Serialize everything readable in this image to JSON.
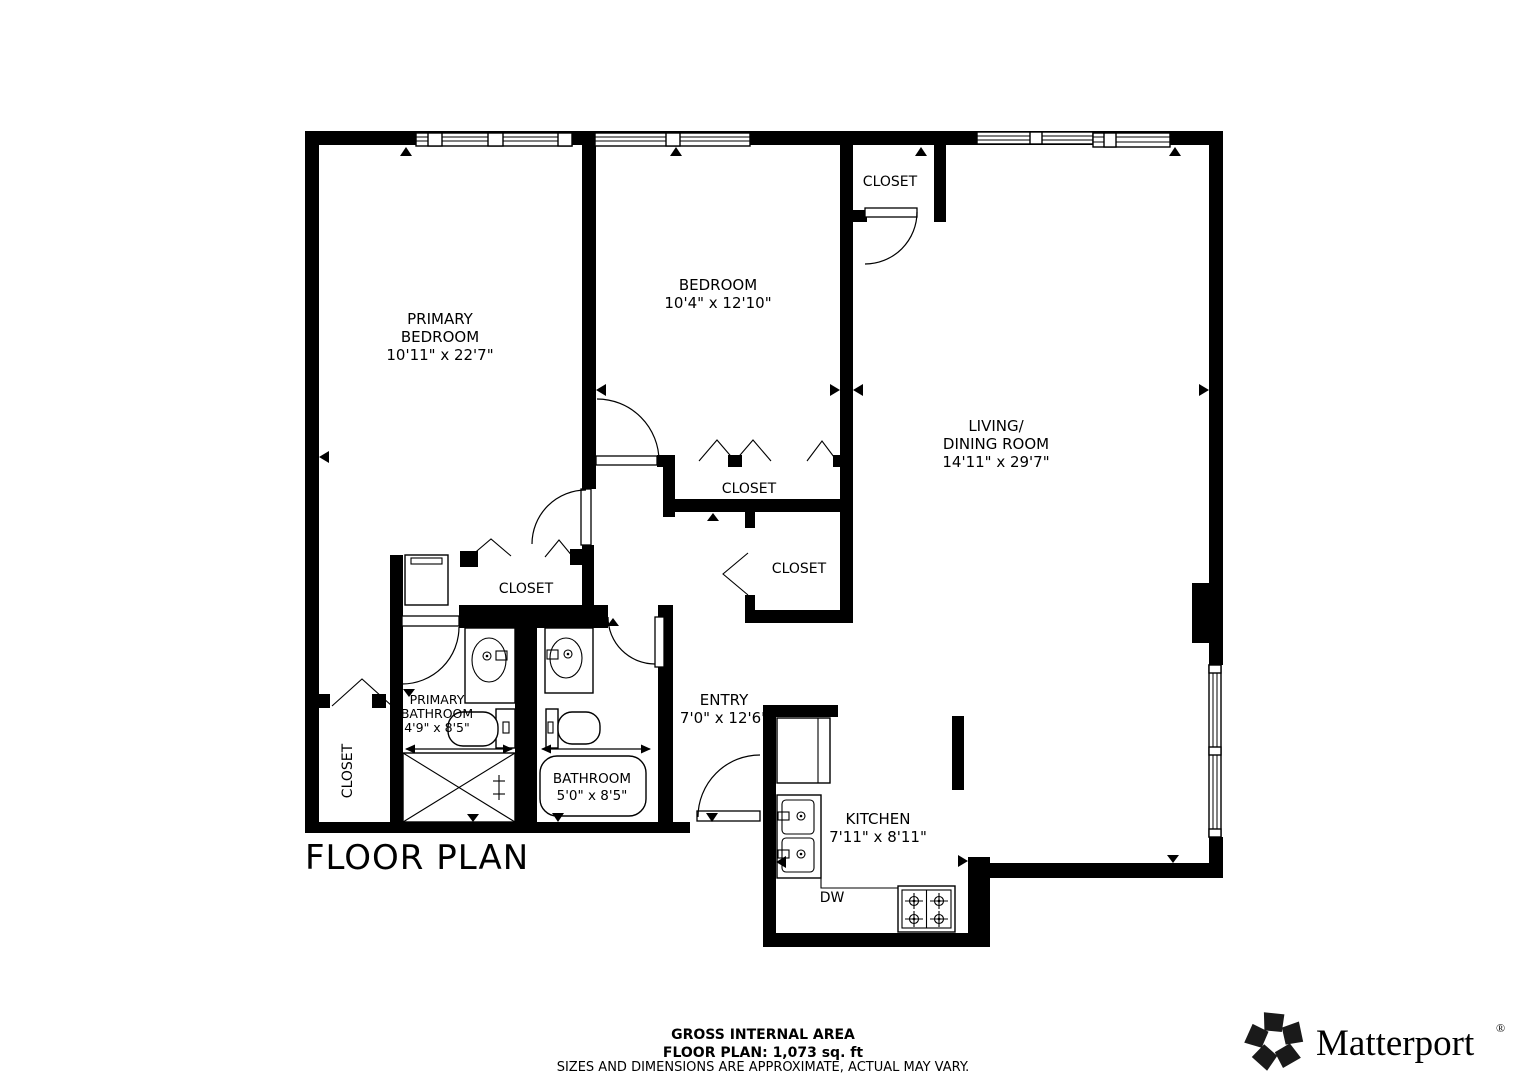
{
  "title": "FLOOR PLAN",
  "plan": {
    "rooms": {
      "primary_bedroom": {
        "lines": [
          "PRIMARY",
          "BEDROOM",
          "10'11\" x 22'7\""
        ]
      },
      "bedroom": {
        "lines": [
          "BEDROOM",
          "10'4\" x 12'10\""
        ]
      },
      "living_dining": {
        "lines": [
          "LIVING/",
          "DINING ROOM",
          "14'11\" x 29'7\""
        ]
      },
      "entry": {
        "lines": [
          "ENTRY",
          "7'0\" x 12'6\""
        ]
      },
      "kitchen": {
        "lines": [
          "KITCHEN",
          "7'11\" x 8'11\""
        ]
      },
      "primary_bathroom": {
        "lines": [
          "PRIMARY",
          "BATHROOM",
          "4'9\" x 8'5\""
        ]
      },
      "bathroom": {
        "lines": [
          "BATHROOM",
          "5'0\" x 8'5\""
        ]
      },
      "closet": {
        "label": "CLOSET"
      },
      "dishwasher": {
        "label": "DW"
      }
    }
  },
  "footer": {
    "line1": "GROSS INTERNAL AREA",
    "line2": "FLOOR PLAN: 1,073 sq. ft",
    "disclaimer": "SIZES AND DIMENSIONS ARE APPROXIMATE, ACTUAL MAY VARY."
  },
  "brand": {
    "name": "Matterport",
    "registered": "®"
  },
  "colors": {
    "wall": "#000000",
    "background": "#ffffff",
    "disclaimer": "#b5b5b5",
    "logo": "#1a1a1a"
  }
}
